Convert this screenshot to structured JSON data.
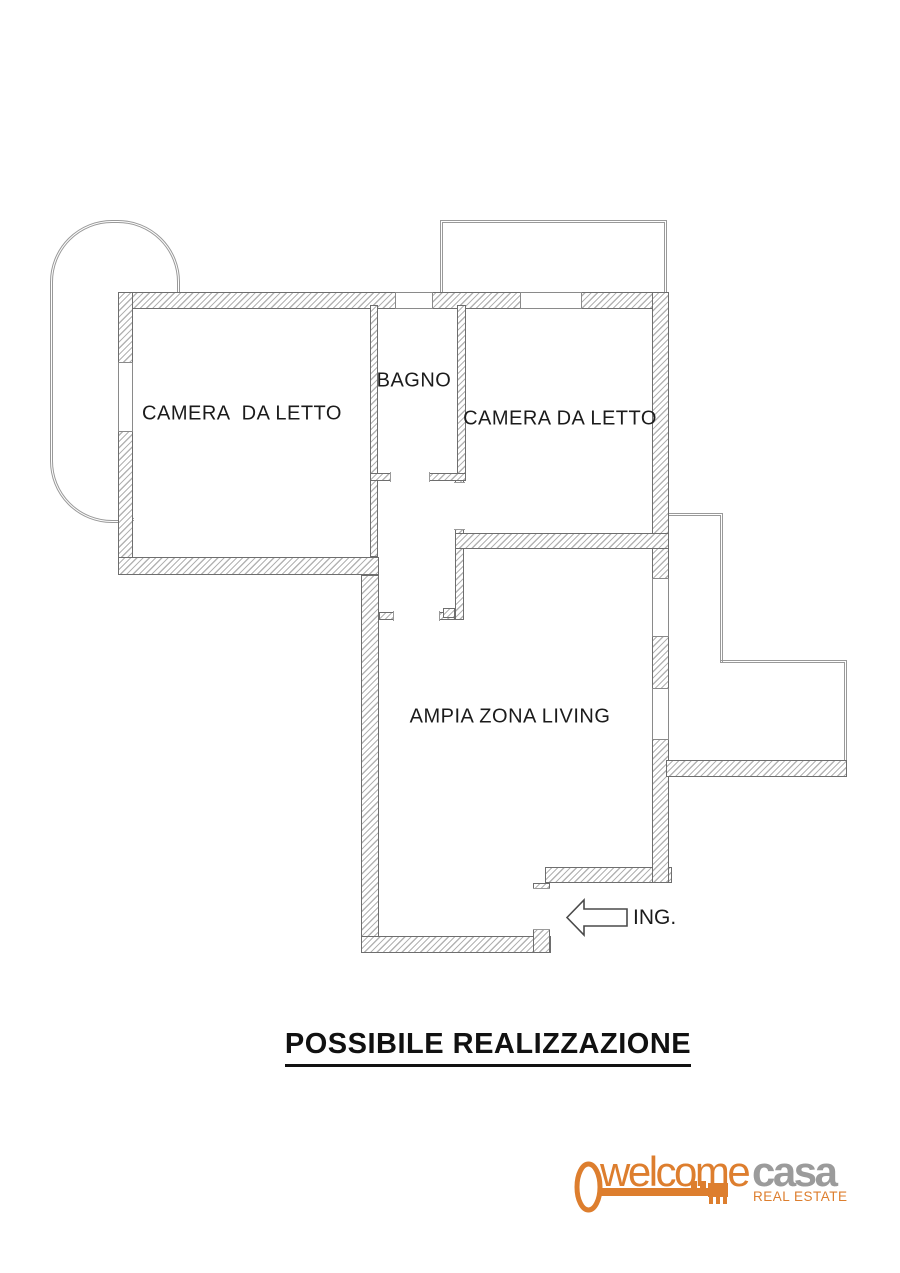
{
  "title": {
    "text": "POSSIBILE REALIZZAZIONE"
  },
  "plan": {
    "rooms": [
      {
        "label": "CAMERA  DA LETTO"
      },
      {
        "label": "BAGNO"
      },
      {
        "label": "CAMERA DA LETTO"
      },
      {
        "label": "AMPIA ZONA LIVING"
      }
    ],
    "entrance_label": "ING."
  },
  "logo": {
    "word1": "welcome",
    "word2": "casa",
    "tagline": "REAL ESTATE",
    "orange": "#DD7E2E",
    "gray": "#9B9B9B"
  },
  "colors": {
    "wall_line": "#6e6e6e",
    "wall_hatch": "#b3b3b3",
    "railing": "#999999",
    "text": "#1b1b1b"
  }
}
